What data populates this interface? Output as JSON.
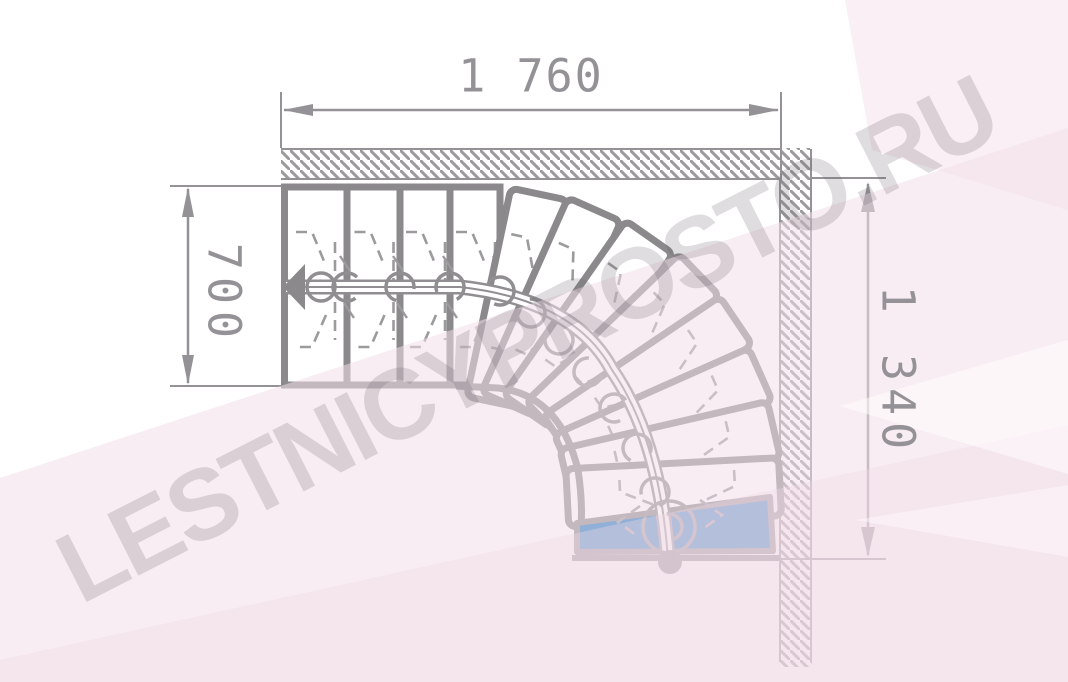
{
  "drawing": {
    "watermark": "LESTNICYPROSTO.RU",
    "dimensions": {
      "top": "1 760",
      "left": "700",
      "right": "1 340"
    },
    "colors": {
      "line": "#8b898b",
      "dimension": "#949296",
      "hatch": "#9c9a9d",
      "highlight_step_blue": "#1a78c2",
      "facet_pink": "#f3dfe9",
      "tread_fill": "#ffffff"
    },
    "stairs": {
      "step_count_straight": 4,
      "step_count_winder": 8,
      "step_count_highlighted": 1,
      "straight_risers_x": [
        283,
        347,
        400,
        450,
        500
      ],
      "flight_top_y": 187,
      "flight_bottom_y": 385,
      "fan_treads": [
        {
          "x": 538,
          "y": 200,
          "a": 12
        },
        {
          "x": 592,
          "y": 215,
          "a": 24
        },
        {
          "x": 646,
          "y": 242,
          "a": 35
        },
        {
          "x": 695,
          "y": 279,
          "a": 46
        },
        {
          "x": 731,
          "y": 324,
          "a": 56
        },
        {
          "x": 755,
          "y": 377,
          "a": 66
        },
        {
          "x": 768,
          "y": 431,
          "a": 77
        },
        {
          "x": 774,
          "y": 487,
          "a": 87
        }
      ],
      "blue_step_points": "577,523 770,497 773,551 577,552",
      "walkline": {
        "path": "M 286 287 H 460 Q 575 300 612 370 Q 660 440 668 560",
        "connectors": [
          [
            321,
            287
          ],
          [
            347,
            287
          ],
          [
            400,
            287
          ],
          [
            450,
            287
          ],
          [
            500,
            291
          ],
          [
            531,
            313
          ],
          [
            559,
            340
          ],
          [
            588,
            372
          ],
          [
            614,
            408
          ],
          [
            637,
            448
          ],
          [
            655,
            492
          ]
        ],
        "big_connector": [
          669,
          527
        ],
        "end_dot": [
          670,
          562
        ]
      }
    }
  }
}
